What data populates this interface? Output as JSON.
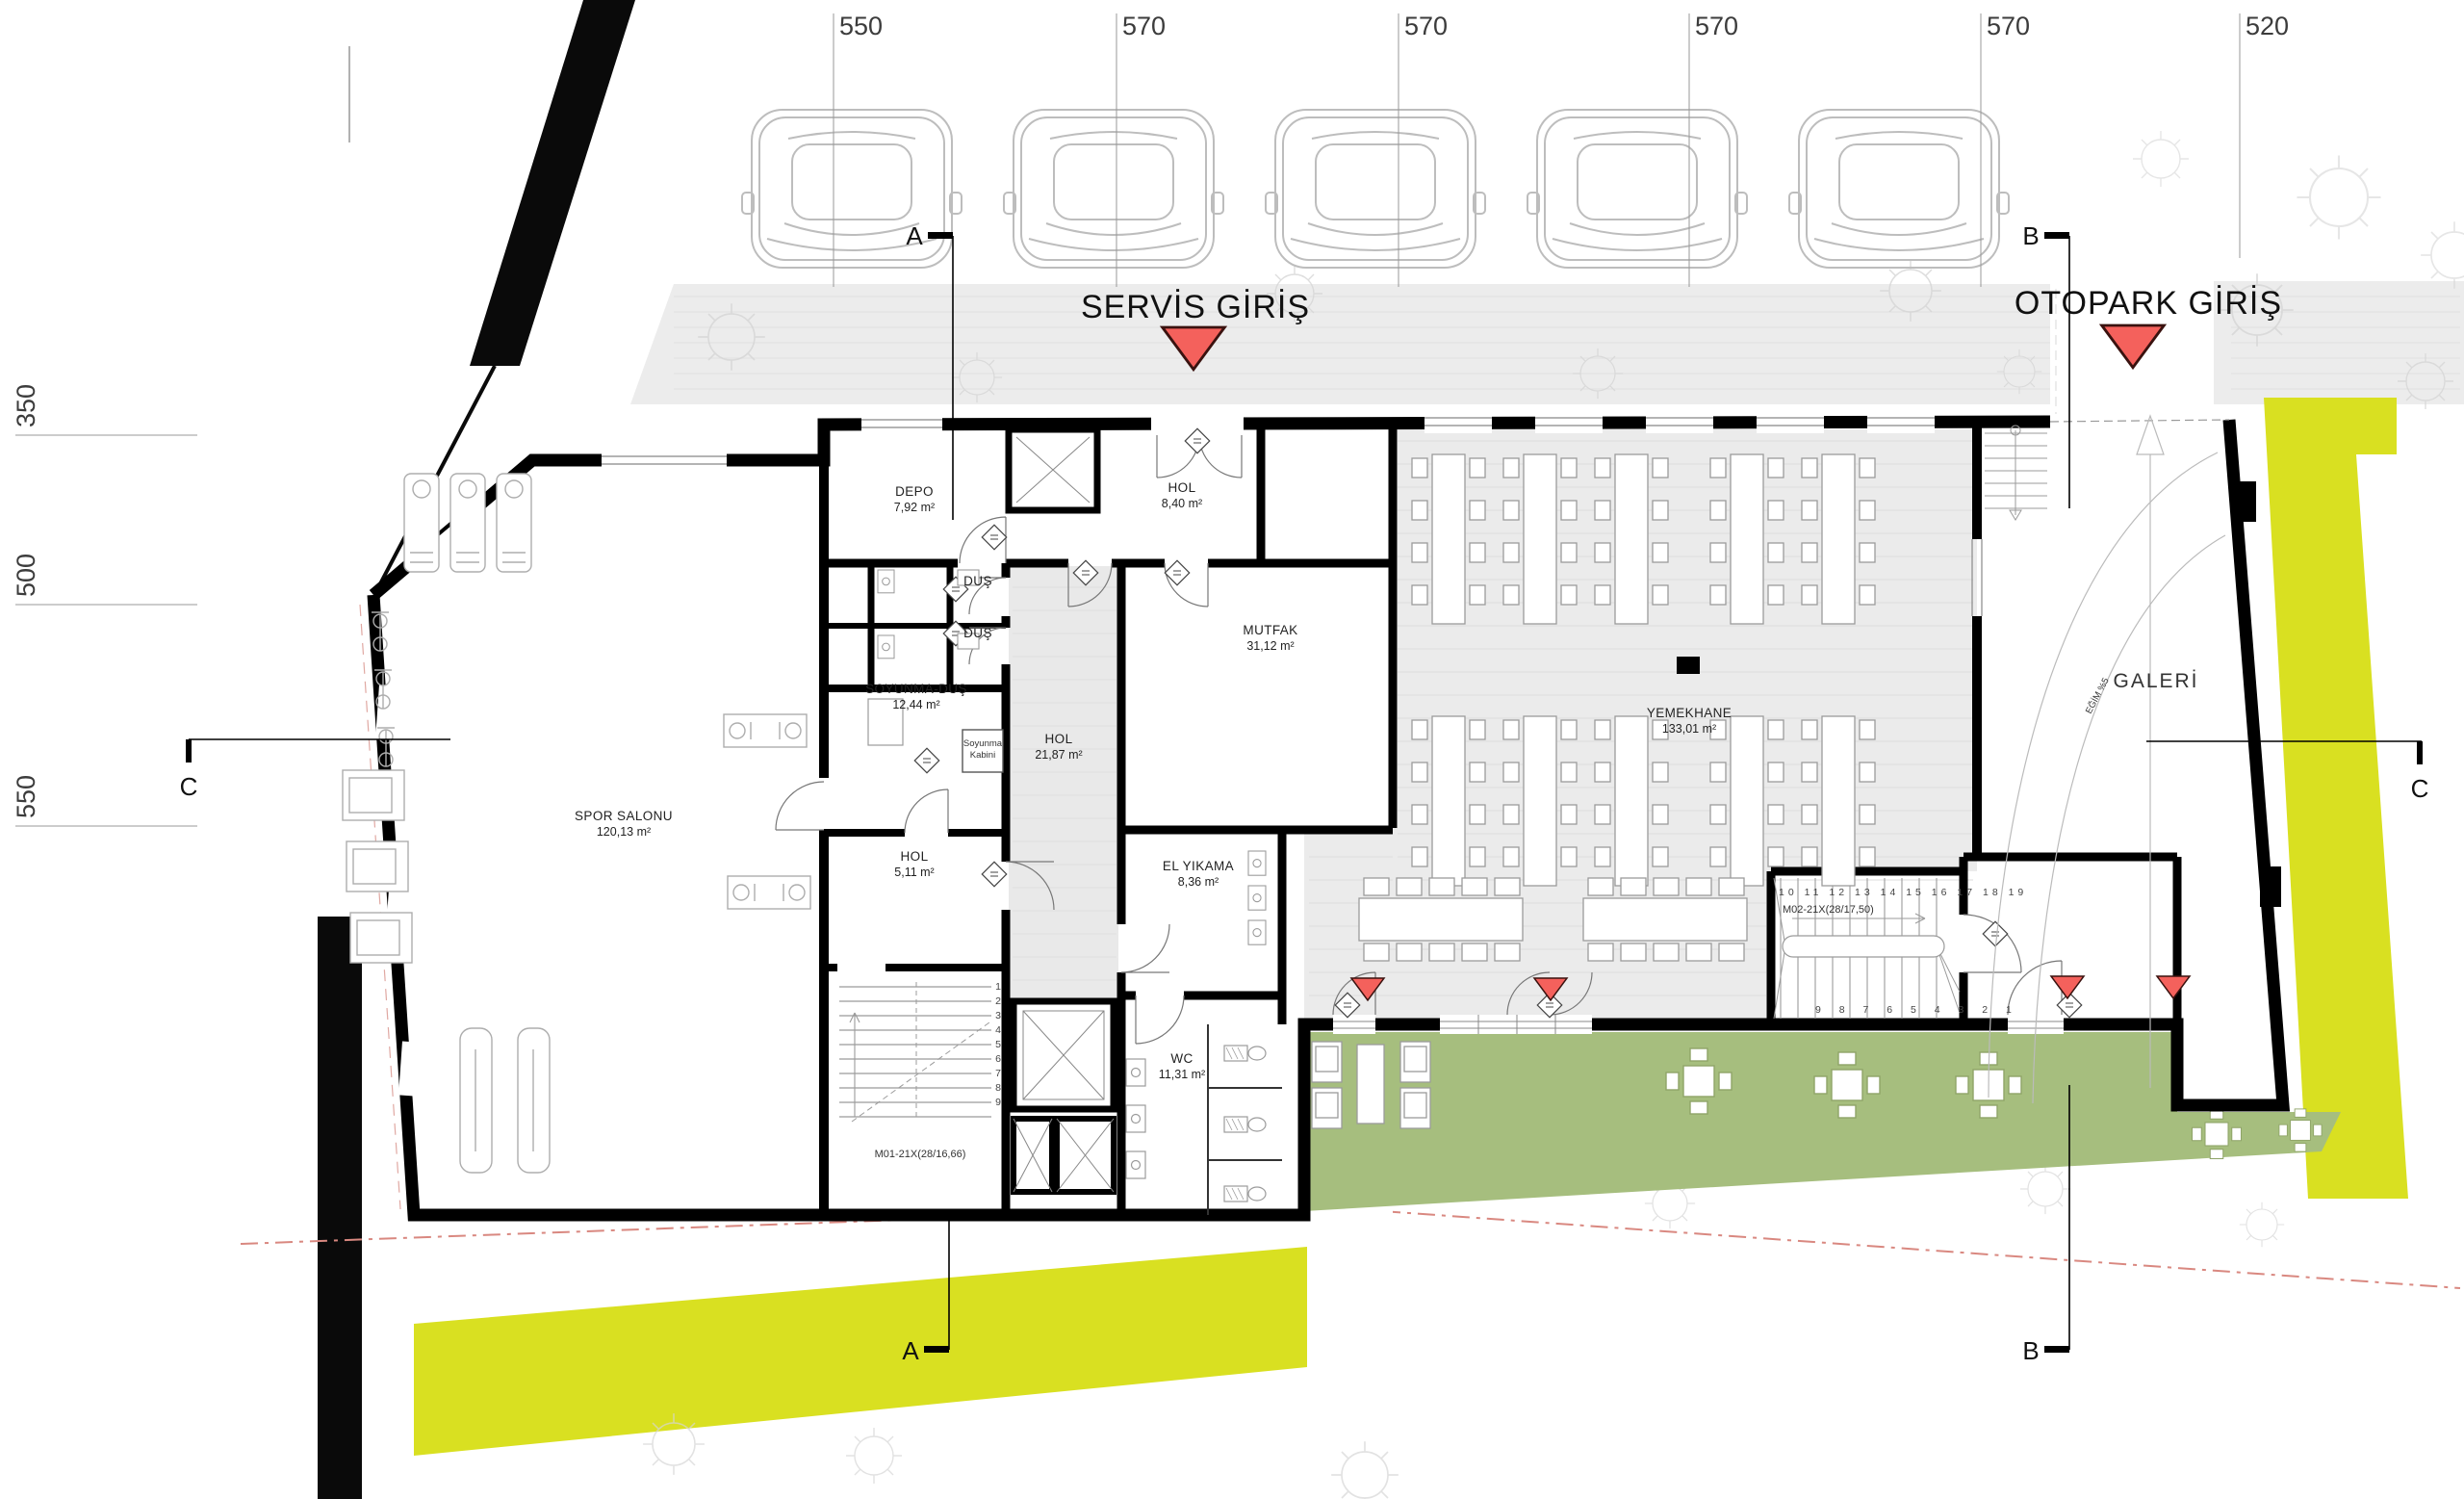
{
  "dimensions": {
    "top": [
      "550",
      "570",
      "570",
      "570",
      "570",
      "520"
    ],
    "left": [
      "350",
      "500",
      "550"
    ]
  },
  "entrances": {
    "service": "SERVİS GİRİŞ",
    "parking": "OTOPARK GİRİŞ"
  },
  "sections": {
    "a": "A",
    "b": "B",
    "c": "C"
  },
  "rooms": {
    "spor": {
      "name": "SPOR SALONU",
      "area": "120,13 m²"
    },
    "depo": {
      "name": "DEPO",
      "area": "7,92 m²"
    },
    "hol_ust": {
      "name": "HOL",
      "area": "8,40 m²"
    },
    "dus_1": {
      "name": "DUŞ"
    },
    "dus_2": {
      "name": "DUŞ"
    },
    "soyunma": {
      "name": "SOYUNMA-DUŞ",
      "area": "12,44 m²"
    },
    "kabin": {
      "line1": "Soyunma",
      "line2": "Kabini"
    },
    "hol_orta": {
      "name": "HOL",
      "area": "21,87 m²"
    },
    "mutfak": {
      "name": "MUTFAK",
      "area": "31,12 m²"
    },
    "yemekhane": {
      "name": "YEMEKHANE",
      "area": "133,01 m²"
    },
    "hol_alt": {
      "name": "HOL",
      "area": "5,11 m²"
    },
    "el_yikama": {
      "name": "EL YIKAMA",
      "area": "8,36 m²"
    },
    "wc": {
      "name": "WC",
      "area": "11,31 m²"
    },
    "galeri": {
      "name": "GALERİ"
    },
    "egim": {
      "label": "EĞİM %5"
    }
  },
  "stairs": {
    "m01": {
      "label": "M01-21X(28/16,66)",
      "steps": [
        "1",
        "2",
        "3",
        "4",
        "5",
        "6",
        "7",
        "8",
        "9"
      ]
    },
    "m02": {
      "label": "M02-21X(28/17,50)",
      "steps_top": [
        "10",
        "11",
        "12",
        "13",
        "14",
        "15",
        "16",
        "17",
        "18",
        "19"
      ],
      "steps_bottom": [
        "9",
        "8",
        "7",
        "6",
        "5",
        "4",
        "3",
        "2",
        "1"
      ]
    }
  },
  "colors": {
    "entrance_arrow": "#F4615C",
    "lime_band": "#D9E021",
    "terrace_green": "#A6BE7E",
    "road_gray": "#ECECEC",
    "floor_gray": "#EBEBEB",
    "corridor_gray": "#E9E9E9",
    "wall_black": "#000000"
  }
}
